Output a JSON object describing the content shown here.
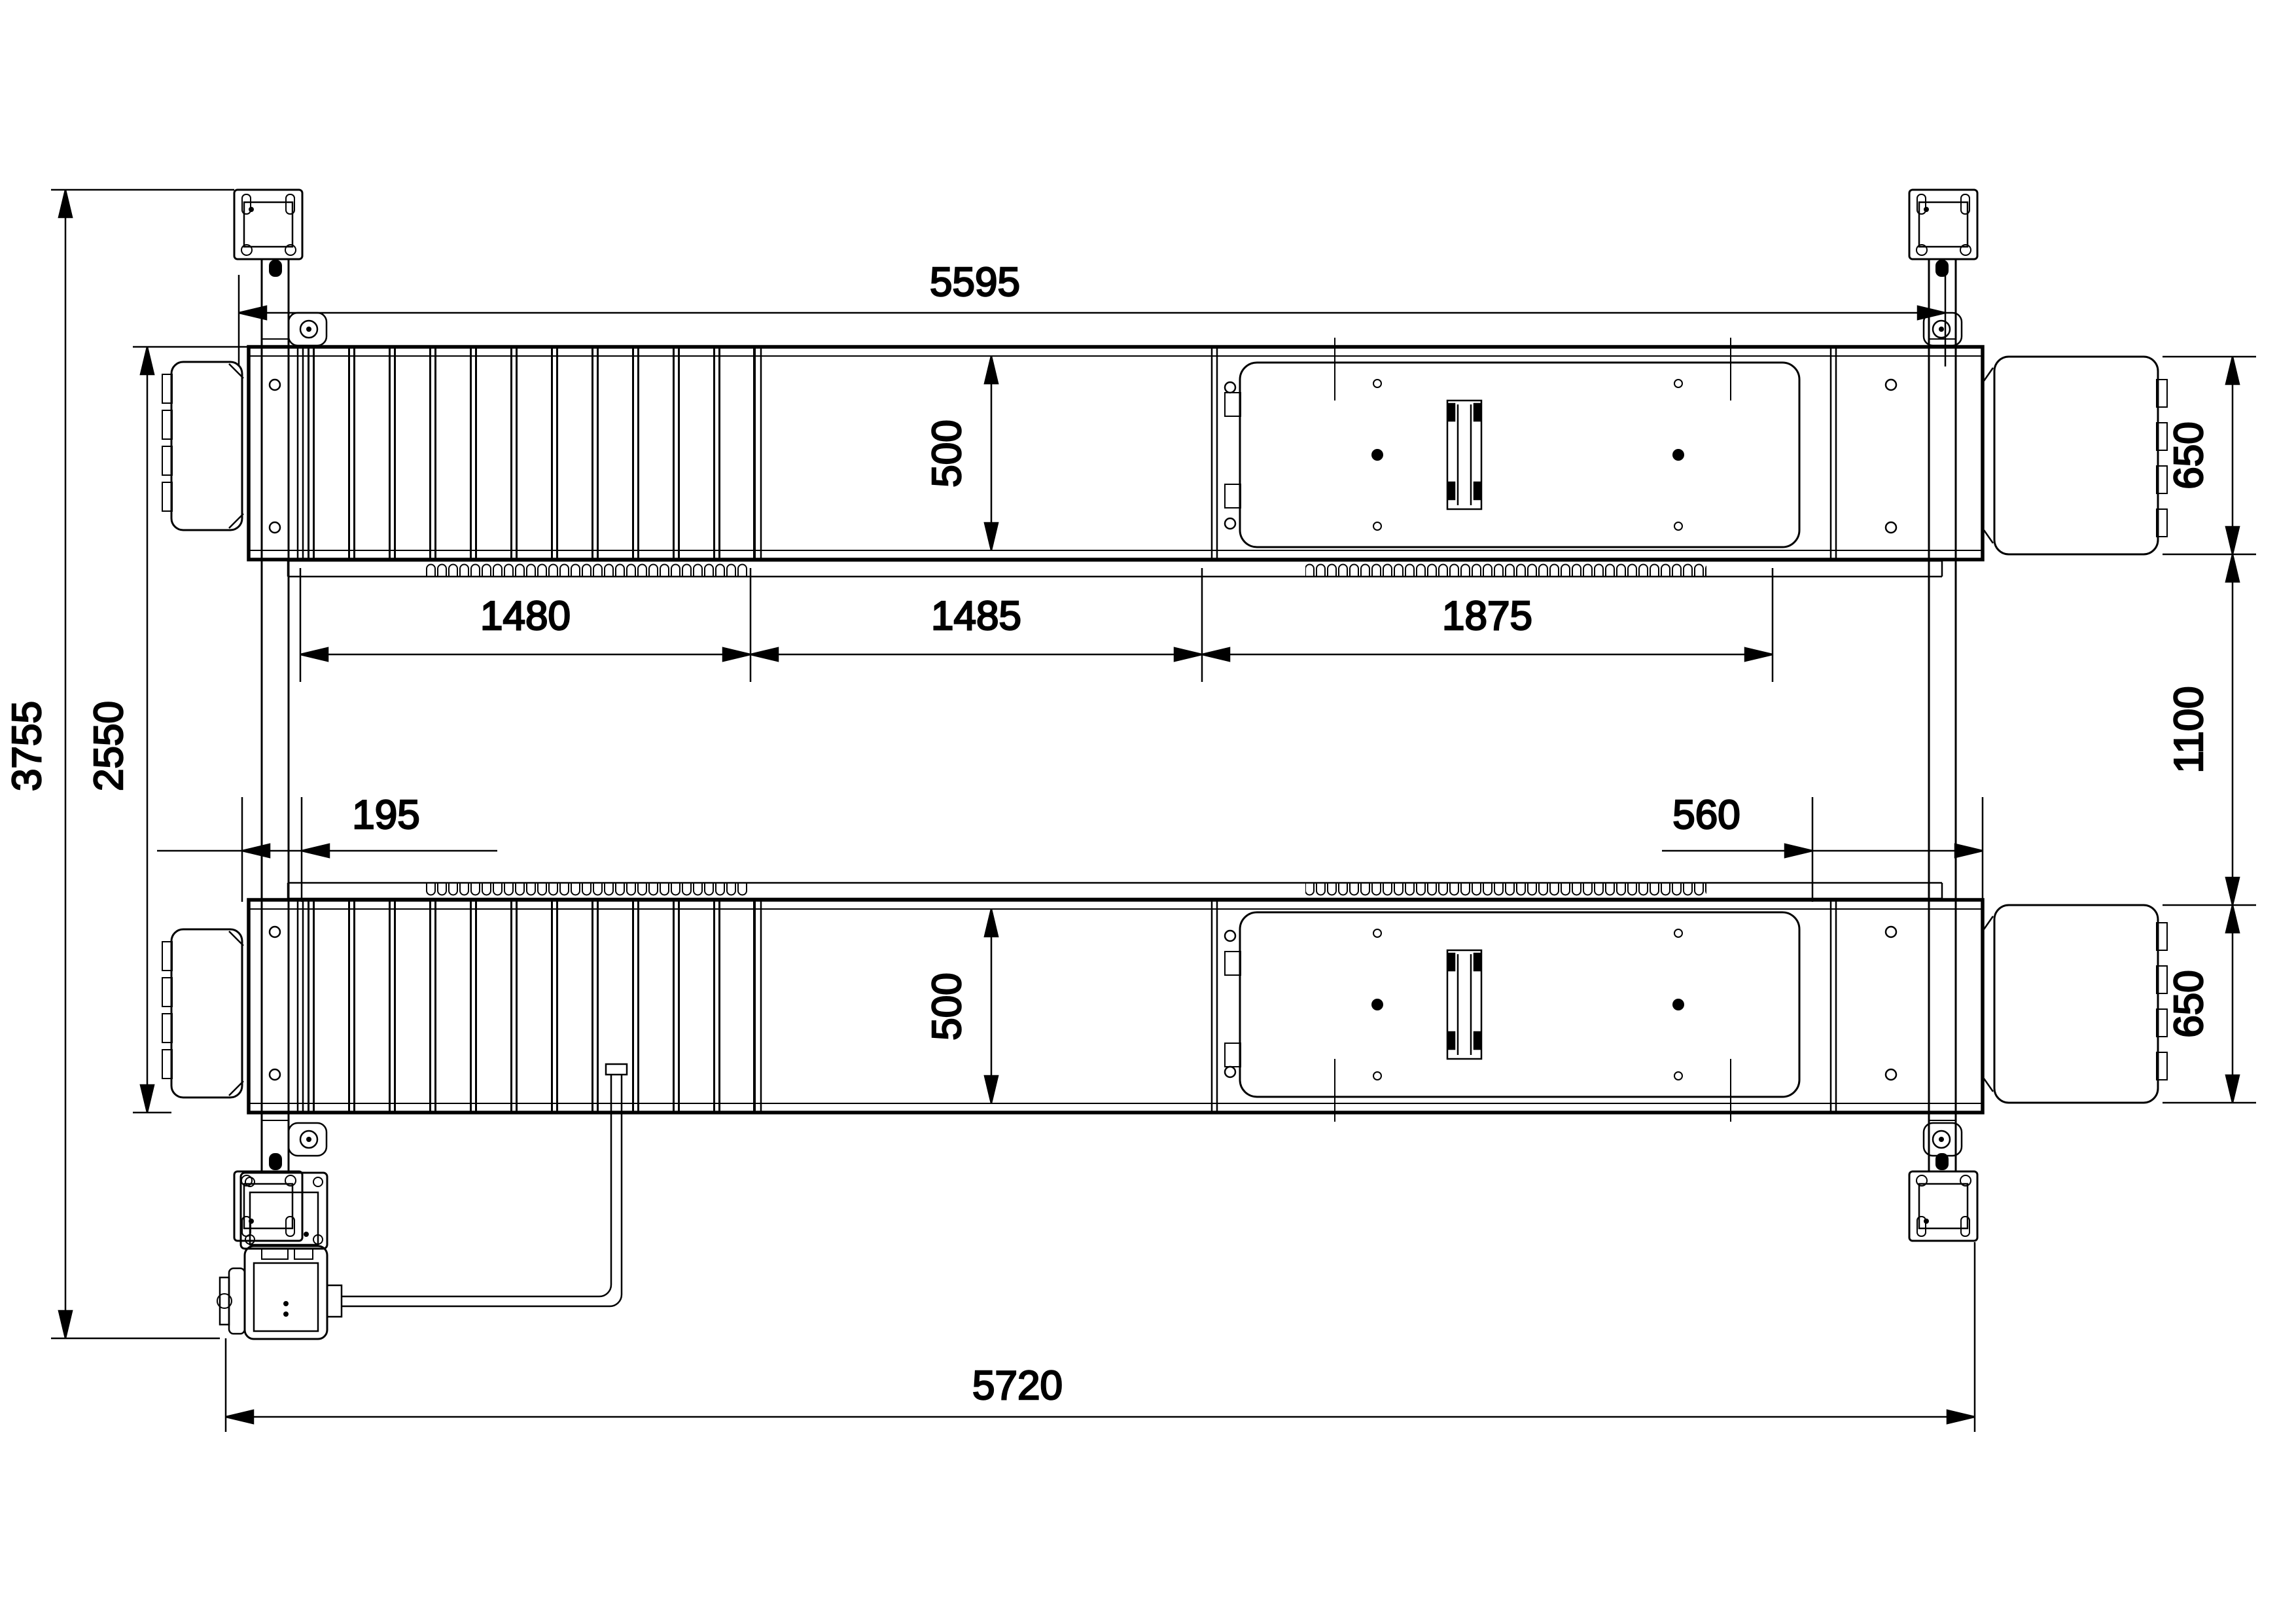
{
  "drawing": {
    "type": "technical-drawing",
    "view": "top-plan",
    "subject": "four-post-vehicle-lift",
    "units": "mm",
    "line_color": "#000000",
    "background_color": "#ffffff",
    "dimensions": {
      "overall_top_span": "5595",
      "overall_bottom_span": "5720",
      "overall_width": "3755",
      "runway_outer_width": "2550",
      "runway_segment_rib": "1480",
      "runway_segment_mid": "1485",
      "runway_segment_plate": "1875",
      "left_offset": "195",
      "right_offset": "560",
      "runway_inner_width_front": "500",
      "runway_inner_width_rear": "500",
      "ramp_width_front": "650",
      "track_gap": "1100",
      "ramp_width_rear": "650"
    }
  }
}
